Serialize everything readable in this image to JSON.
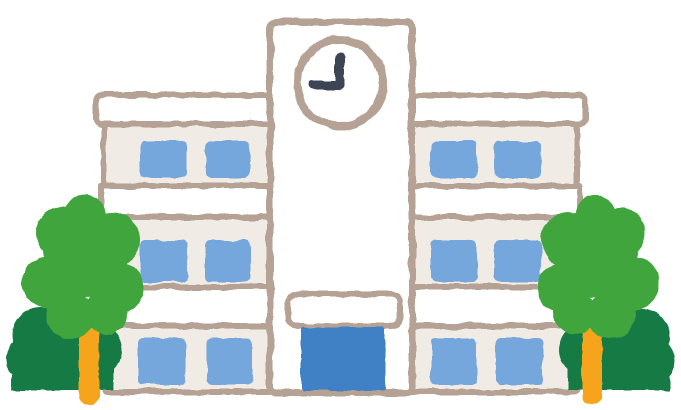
{
  "scene": {
    "subject": "school-building-illustration",
    "clock_time_shown": "9:00",
    "building": {
      "wings": 2,
      "floors_per_wing": 3,
      "windows_per_floor_per_wing": 2,
      "has_clock_tower": true,
      "has_entrance_canopy": true,
      "has_entrance_door": true
    },
    "trees": {
      "left_group": 2,
      "right_group": 2
    }
  },
  "colors": {
    "background": "#ffffff",
    "outline": "#b5a294",
    "wall": "#f0ebe4",
    "white": "#ffffff",
    "window": "#74a6dc",
    "door": "#4080c4",
    "clock_hands": "#3c4454",
    "tree_light": "#3fa53c",
    "tree_dark": "#137a45",
    "trunk": "#f6a41f"
  }
}
